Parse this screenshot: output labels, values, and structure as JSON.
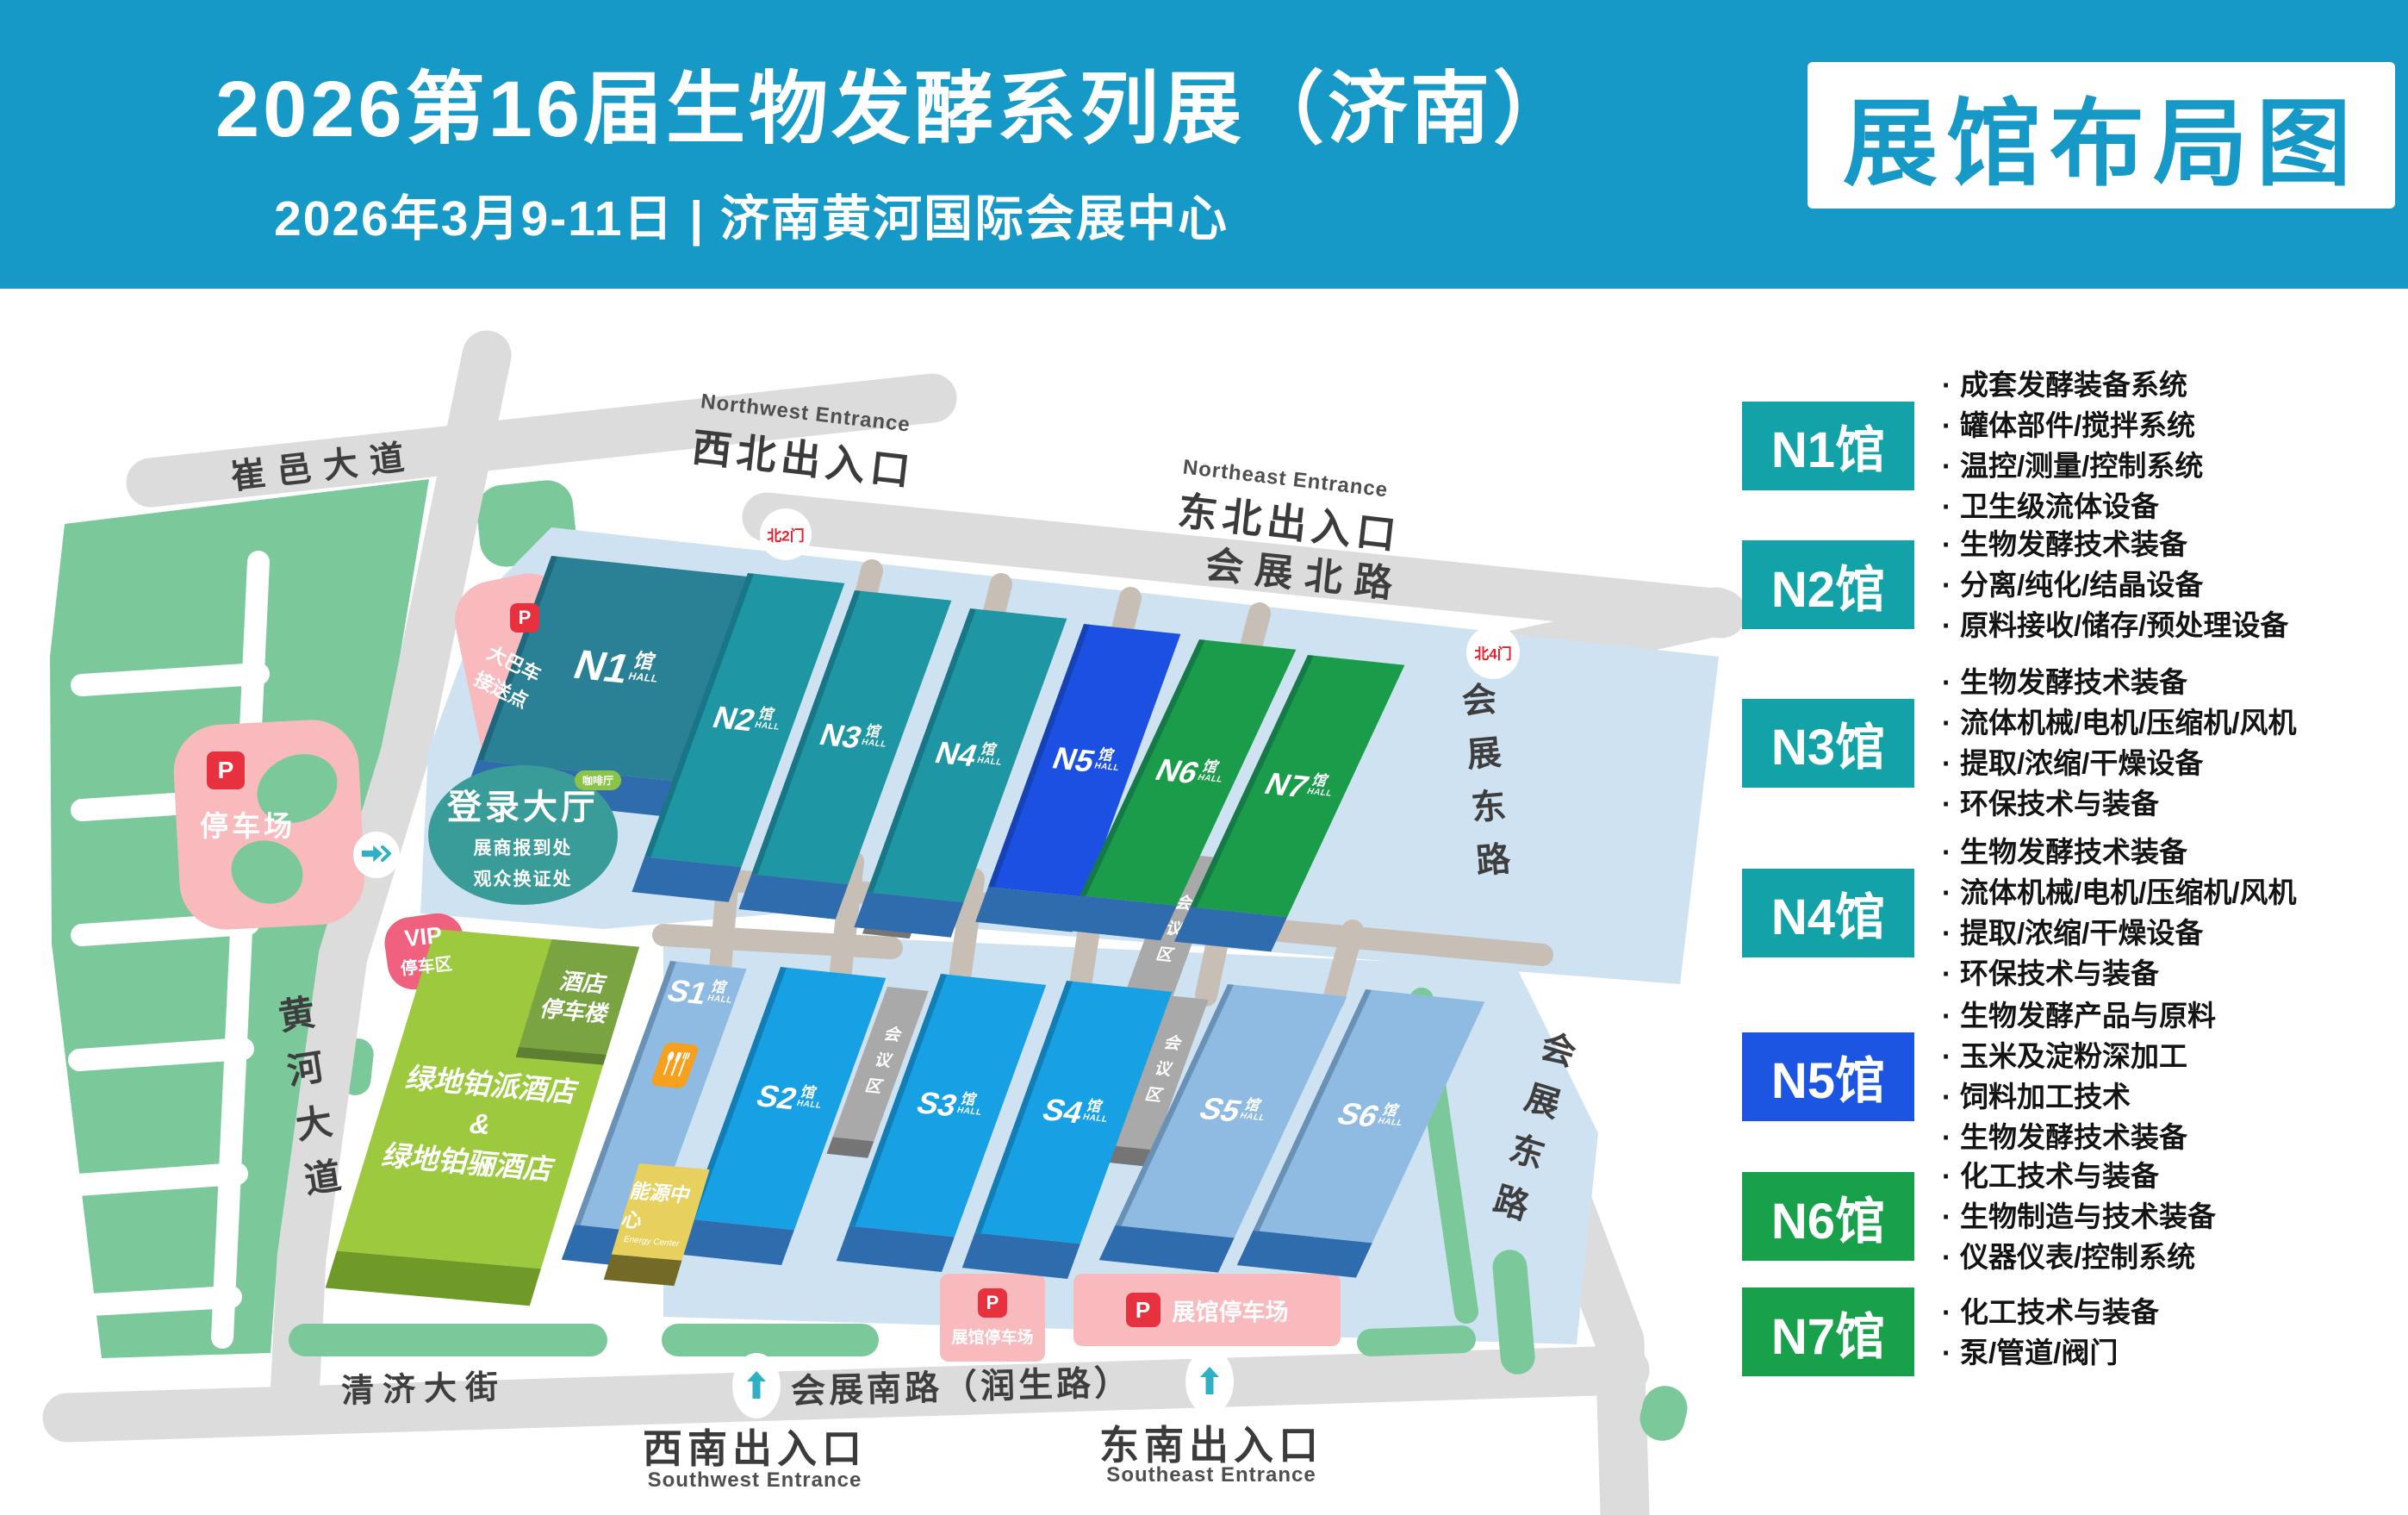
{
  "header": {
    "title": "2026第16届生物发酵系列展（济南）",
    "subtitle": "2026年3月9-11日 | 济南黄河国际会展中心",
    "badge": "展馆布局图"
  },
  "colors": {
    "header_cyan": "#1699c6",
    "legend_teal": "#12a2a7",
    "legend_blue": "#1b55e2",
    "legend_green": "#18a04b",
    "hall_teal": "#1f96a3",
    "hall_blue": "#1b50e2",
    "hall_green": "#1b9c4b",
    "hall_bright_blue": "#18a0e4",
    "hall_light_blue": "#8fbbe2",
    "road_gray": "#dcdcdc",
    "green_area": "#7bc89b",
    "pink_parking": "#f9babe",
    "platform_blue": "#cfe2f1"
  },
  "legend": [
    {
      "name": "N1馆",
      "bullets": [
        "成套发酵装备系统",
        "罐体部件/搅拌系统",
        "温控/测量/控制系统",
        "卫生级流体设备"
      ]
    },
    {
      "name": "N2馆",
      "bullets": [
        "生物发酵技术装备",
        "分离/纯化/结晶设备",
        "原料接收/储存/预处理设备"
      ]
    },
    {
      "name": "N3馆",
      "bullets": [
        "生物发酵技术装备",
        "流体机械/电机/压缩机/风机",
        "提取/浓缩/干燥设备",
        "环保技术与装备"
      ]
    },
    {
      "name": "N4馆",
      "bullets": [
        "生物发酵技术装备",
        "流体机械/电机/压缩机/风机",
        "提取/浓缩/干燥设备",
        "环保技术与装备"
      ]
    },
    {
      "name": "N5馆",
      "bullets": [
        "生物发酵产品与原料",
        "玉米及淀粉深加工",
        "饲料加工技术",
        "生物发酵技术装备"
      ]
    },
    {
      "name": "N6馆",
      "bullets": [
        "化工技术与装备",
        "生物制造与技术装备",
        "仪器仪表/控制系统"
      ]
    },
    {
      "name": "N7馆",
      "bullets": [
        "化工技术与装备",
        "泵/管道/阀门"
      ]
    }
  ],
  "map": {
    "roads": {
      "cuiyi": "崔邑大道",
      "north": "会展北路",
      "east1": "会展东路",
      "east2": "会展东路",
      "huanghe": "黄河大道",
      "qingji": "清济大街",
      "south": "会展南路（润生路）"
    },
    "gates": {
      "n2": "北2门",
      "n4": "北4门"
    },
    "entrances": {
      "nw_en": "Northwest Entrance",
      "nw_cn": "西北出入口",
      "ne_en": "Northeast Entrance",
      "ne_cn": "东北出入口",
      "sw_cn": "西南出入口",
      "sw_en": "Southwest Entrance",
      "se_cn": "东南出入口",
      "se_en": "Southeast Entrance"
    },
    "halls_n": [
      {
        "num": "N1",
        "cn": "馆",
        "en": "HALL"
      },
      {
        "num": "N2",
        "cn": "馆",
        "en": "HALL"
      },
      {
        "num": "N3",
        "cn": "馆",
        "en": "HALL"
      },
      {
        "num": "N4",
        "cn": "馆",
        "en": "HALL"
      },
      {
        "num": "N5",
        "cn": "馆",
        "en": "HALL"
      },
      {
        "num": "N6",
        "cn": "馆",
        "en": "HALL"
      },
      {
        "num": "N7",
        "cn": "馆",
        "en": "HALL"
      }
    ],
    "halls_s": [
      {
        "num": "S1",
        "cn": "馆",
        "en": "HALL"
      },
      {
        "num": "S2",
        "cn": "馆",
        "en": "HALL"
      },
      {
        "num": "S3",
        "cn": "馆",
        "en": "HALL"
      },
      {
        "num": "S4",
        "cn": "馆",
        "en": "HALL"
      },
      {
        "num": "S5",
        "cn": "馆",
        "en": "HALL"
      },
      {
        "num": "S6",
        "cn": "馆",
        "en": "HALL"
      }
    ],
    "conference": "会议区",
    "login": {
      "title": "登录大厅",
      "line1": "展商报到处",
      "line2": "观众换证处",
      "badge": "咖啡厅"
    },
    "vip_line1": "VIP",
    "vip_line2": "停车区",
    "bus_line1": "大巴车",
    "bus_line2": "接送点",
    "parking_west": "停车场",
    "parking_hall_a": "展馆停车场",
    "parking_hall_b": "展馆停车场",
    "hotel": {
      "line1": "绿地铂派酒店",
      "amp": "&",
      "line2": "绿地铂骊酒店",
      "deck1": "酒店",
      "deck2": "停车楼"
    },
    "energy_cn": "能源中心",
    "energy_en": "Energy Center",
    "p": "P"
  }
}
